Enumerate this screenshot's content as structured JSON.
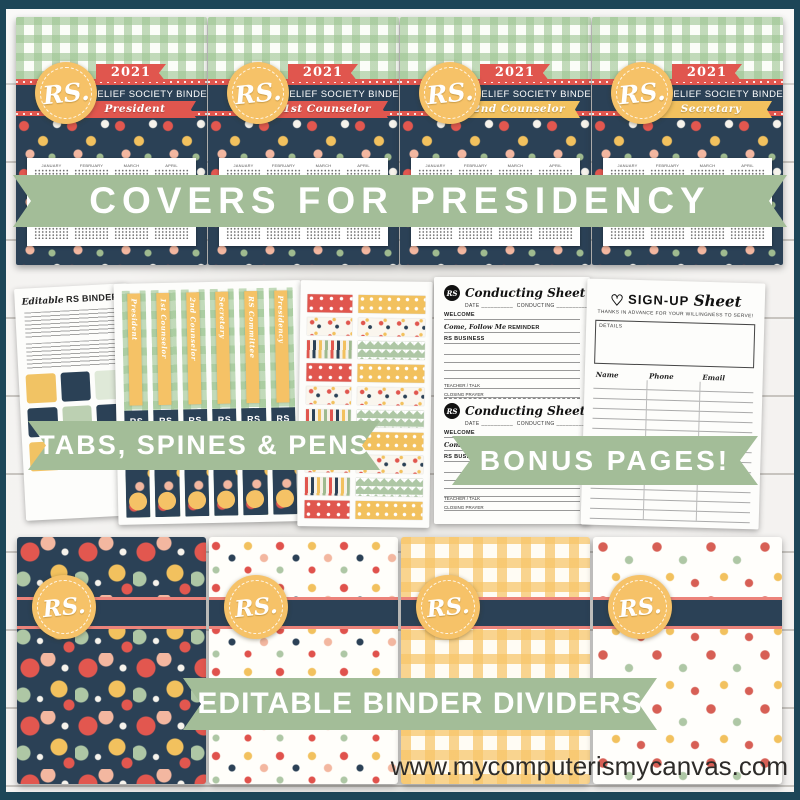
{
  "watermark": "www.mycomputerismycanvas.com",
  "banners": {
    "top": "COVERS FOR PRESIDENCY",
    "middle_left": "TABS, SPINES & PENS",
    "middle_right": "BONUS PAGES!",
    "bottom": "EDITABLE BINDER DIVIDERS",
    "ribbon_color": "#a3bd98"
  },
  "badge": {
    "text": "RS."
  },
  "covers": {
    "year": "2021",
    "title": "RELIEF SOCIETY BINDER",
    "items": [
      {
        "subtitle": "President",
        "ribbon_color": "#e0564e"
      },
      {
        "subtitle": "1st Counselor",
        "ribbon_color": "#e0564e"
      },
      {
        "subtitle": "2nd Counselor",
        "ribbon_color": "#f2c15e"
      },
      {
        "subtitle": "Secretary",
        "ribbon_color": "#f2c15e"
      }
    ],
    "calendar_months": [
      "JANUARY",
      "FEBRUARY",
      "MARCH",
      "APRIL",
      "MAY",
      "JUNE",
      "JULY",
      "AUGUST",
      "SEPTEMBER",
      "OCTOBER",
      "NOVEMBER",
      "DECEMBER"
    ]
  },
  "tabs_page": {
    "title_script": "Editable",
    "title_main": "RS BINDER TABS",
    "tab_colors": [
      "#f1c364",
      "#2b4156",
      "#dfe9d8",
      "#2b4156",
      "#bcd0b2",
      "#2b4156",
      "#f1c364",
      "#35566b",
      "#f4efe5"
    ]
  },
  "spines_page": {
    "spine_line1": "RS",
    "spine_line2": "BINDER",
    "labels": [
      "President",
      "1st Counselor",
      "2nd Counselor",
      "Secretary",
      "RS Committee",
      "Presidency"
    ]
  },
  "pens_page": {
    "left_patterns": [
      "red-dot",
      "floral",
      "stripe",
      "red-dot",
      "floral",
      "stripe",
      "red-dot",
      "floral",
      "stripe",
      "red-dot"
    ],
    "right_patterns": [
      "yellow-dot",
      "floral",
      "sage-zig",
      "yellow-dot",
      "floral",
      "sage-zig",
      "yellow-dot",
      "floral",
      "sage-zig",
      "yellow-dot"
    ]
  },
  "conducting_sheet": {
    "title": "Conducting Sheet",
    "date_label": "DATE __________",
    "conducting_label": "CONDUCTING ____________",
    "welcome_label": "WELCOME",
    "reminder_script": "Come, Follow Me",
    "reminder_label": "REMINDER",
    "business_label": "RS BUSINESS",
    "teacher_label": "TEACHER / TALK",
    "closing_label": "CLOSING PRAYER"
  },
  "signup_sheet": {
    "title_caps": "SIGN-UP",
    "title_script": "Sheet",
    "subtitle": "THANKS IN ADVANCE FOR YOUR WILLINGNESS TO SERVE!",
    "details_label": "DETAILS",
    "columns": [
      "Name",
      "Phone",
      "Email"
    ],
    "row_count": 14
  },
  "colors": {
    "frame": "#1d4658",
    "wood": "#e9e7e3",
    "navy": "#2b4156",
    "coral": "#e0564e",
    "yellow": "#f2c15e",
    "sage_banner": "#a3bd98",
    "gingham_green": "#9ec593",
    "peach": "#f3b7a0"
  }
}
